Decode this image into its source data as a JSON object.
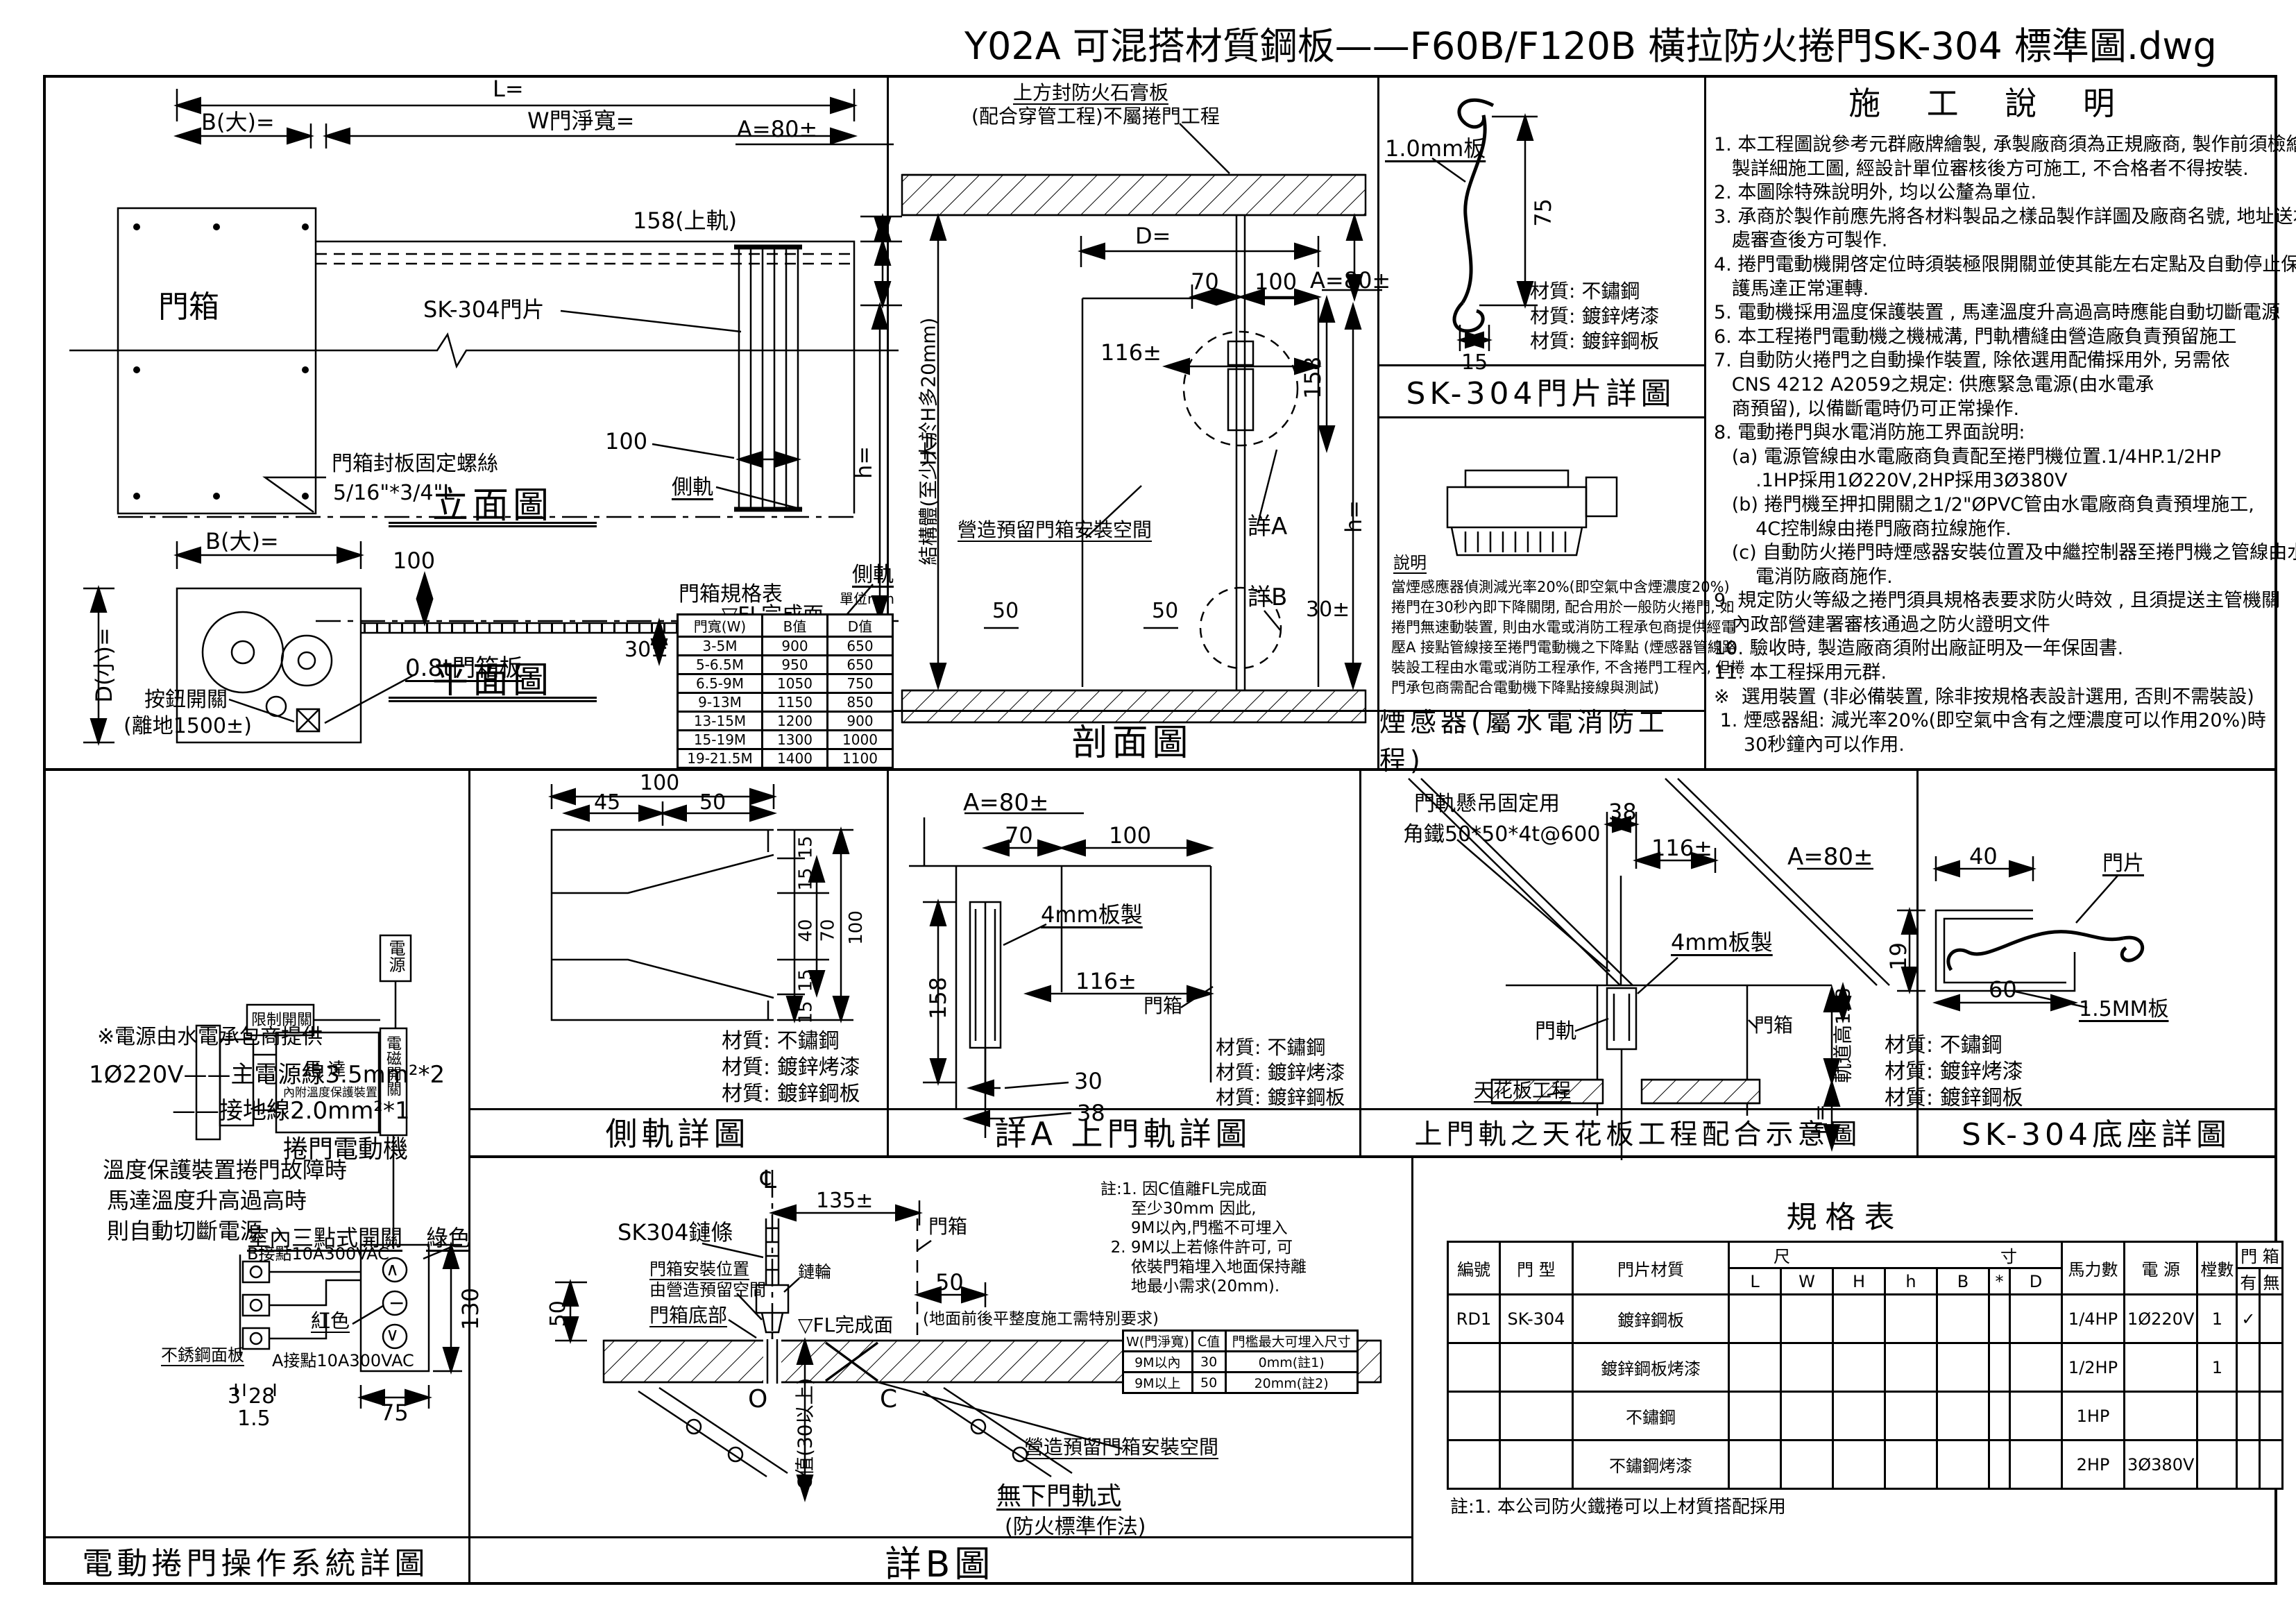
{
  "title": "Y02A 可混搭材質鋼板——F60B/F120B 橫拉防火捲門SK-304 標準圖.dwg",
  "materials": {
    "m1": "材質: 不鏽鋼",
    "m2": "材質: 鍍鋅烤漆",
    "m3": "材質: 鍍鋅鋼板"
  },
  "elevation": {
    "caption": "立面圖",
    "dim_l": "L=",
    "dim_b": "B(大)=",
    "dim_w": "W門淨寬=",
    "dim_a": "A=80±",
    "dim_rail": "158(上軌)",
    "dim_100": "100",
    "dim_h": "h=",
    "dim_30": "30±",
    "label_box": "門箱",
    "label_slat": "SK-304門片",
    "label_screw1": "門箱封板固定螺絲",
    "label_screw2": "5/16\"*3/4\"L",
    "label_siderail": "側軌",
    "label_fl": "▽FL完成面",
    "label_fl_note1": "(地面前後平整度",
    "label_fl_note2": "施工需特別要求)"
  },
  "plan": {
    "caption": "平面圖",
    "dim_b": "B(大)=",
    "dim_100": "100",
    "dim_d": "D(小)=",
    "label_switch1": "按鈕開關",
    "label_switch2": "(離地1500±)",
    "label_boxplate": "0.8t門箱板",
    "label_siderail": "側軌",
    "table": {
      "title": "門箱規格表",
      "unit": "單位mm",
      "h": [
        "門寬(W)",
        "B值",
        "D值"
      ],
      "rows": [
        [
          "3-5M",
          "900",
          "650"
        ],
        [
          "5-6.5M",
          "950",
          "650"
        ],
        [
          "6.5-9M",
          "1050",
          "750"
        ],
        [
          "9-13M",
          "1150",
          "850"
        ],
        [
          "13-15M",
          "1200",
          "900"
        ],
        [
          "15-19M",
          "1300",
          "1000"
        ],
        [
          "19-21.5M",
          "1400",
          "1100"
        ]
      ]
    }
  },
  "section": {
    "caption": "剖面圖",
    "note1": "上方封防火石膏板",
    "note2": "(配合穿管工程)不屬捲門工程",
    "dim_d": "D=",
    "dim_70": "70",
    "dim_100": "100",
    "dim_a": "A=80±",
    "dim_116": "116±",
    "dim_158": "158",
    "dim_50a": "50",
    "dim_50b": "50",
    "dim_30": "30±",
    "dim_h": "h=",
    "dim_H": "H=",
    "label_struct": "結構體(至少大於H多20mm)",
    "label_space": "營造預留門箱安裝空間",
    "label_detailA": "詳A",
    "label_detailB": "詳B"
  },
  "slat": {
    "caption": "SK-304門片詳圖",
    "dim_75": "75",
    "dim_15": "15",
    "label_plate": "1.0mm板"
  },
  "smoke": {
    "caption": "煙感器(屬水電消防工程)",
    "note_title": "說明",
    "lines": [
      "當煙感應器偵測減光率20%(即空氣中含煙濃度20%)",
      "捲門在30秒內即下降關閉, 配合用於一般防火捲門, 如",
      "捲門無速動裝置, 則由水電或消防工程承包商提供經電",
      "壓A 接點管線接至捲門電動機之下降點 (煙感器管線路",
      "裝設工程由水電或消防工程承作, 不含捲門工程內, 但捲",
      "門承包商需配合電動機下降點接線與測試)"
    ]
  },
  "notes": {
    "title": "施 工 說 明",
    "lines": [
      "1. 本工程圖說參考元群廠牌繪製, 承製廠商須為正規廠商, 製作前須檢繪",
      "   製詳細施工圖, 經設計單位審核後方可施工, 不合格者不得按裝.",
      "2. 本圖除特殊說明外, 均以公釐為單位.",
      "3. 承商於製作前應先將各材料製品之樣品製作詳圖及廠商名號, 地址送本",
      "   處審查後方可製作.",
      "4. 捲門電動機開啓定位時須裝極限開關並使其能左右定點及自動停止保",
      "   護馬達正常運轉.",
      "5. 電動機採用溫度保護裝置 , 馬達溫度升高過高時應能自動切斷電源",
      "6. 本工程捲門電動機之機械溝, 門軌槽縫由營造廠負責預留施工",
      "7. 自動防火捲門之自動操作裝置, 除依選用配備採用外, 另需依",
      "   CNS 4212 A2059之規定: 供應緊急電源(由水電承",
      "   商預留), 以備斷電時仍可正常操作.",
      "8. 電動捲門與水電消防施工界面說明:",
      "   (a) 電源管線由水電廠商負責配至捲門機位置.1/4HP.1/2HP",
      "       .1HP採用1Ø220V,2HP採用3Ø380V",
      "   (b) 捲門機至押扣開關之1/2\"ØPVC管由水電廠商負責預埋施工,",
      "       4C控制線由捲門廠商拉線施作.",
      "   (c) 自動防火捲門時煙感器安裝位置及中繼控制器至捲門機之管線由水",
      "       電消防廠商施作.",
      "9. 規定防火等級之捲門須具規格表要求防火時效 , 且須提送主管機關",
      "   內政部營建署審核通過之防火證明文件",
      "10. 驗收時, 製造廠商須附出廠証明及一年保固書.",
      "11. 本工程採用元群.",
      "※  選用裝置 (非必備裝置, 除非按規格表設計選用, 否則不需裝設)",
      " 1. 煙感器組: 減光率20%(即空氣中含有之煙濃度可以作用20%)時",
      "     30秒鐘內可以作用."
    ]
  },
  "motor": {
    "caption": "電動捲門操作系統詳圖",
    "power1": "※電源由水電承包商提供",
    "power2": "1Ø220V——主電源線3.5mm²*2",
    "power3": "——接地線2.0mm²*1",
    "label_power": "電源",
    "label_limit": "限制開關",
    "label_motor": "馬 達",
    "label_motor2": "內附溫度保護裝置",
    "label_mag": "電磁開關",
    "label_name": "捲門電動機",
    "temp1": "溫度保護裝置捲門故障時",
    "temp2": "馬達溫度升高過高時",
    "temp3": "則自動切斷電源",
    "label_switch": "室內三點式開關",
    "label_green": "綠色",
    "label_red": "紅色",
    "label_panel": "不銹鋼面板",
    "label_b": "B接點10A300VAC",
    "label_a": "A接點10A300VAC",
    "dim_130": "130",
    "dim_75": "75",
    "dim_3": "3",
    "dim_28": "28",
    "dim_15": "1.5",
    "sym_up": "∧",
    "sym_stop": "−",
    "sym_down": "∨"
  },
  "siderail": {
    "caption": "側軌詳圖",
    "dim_100t": "100",
    "dim_45": "45",
    "dim_50": "50",
    "d15a": "15",
    "d15b": "15",
    "d40": "40",
    "d70": "70",
    "d100": "100",
    "d15c": "15",
    "d15d": "15"
  },
  "detailA": {
    "caption": "詳A   上門軌詳圖",
    "dim_a": "A=80±",
    "dim_70": "70",
    "dim_100": "100",
    "dim_158": "158",
    "dim_116": "116±",
    "dim_30": "30",
    "dim_38": "38",
    "label_4mm": "4mm板製",
    "label_box": "門箱"
  },
  "ceiling": {
    "caption": "上門軌之天花板工程配合示意圖",
    "hang1": "門軌懸吊固定用",
    "hang2": "角鐵50*50*4t@600",
    "dim_38": "38",
    "dim_116": "116±",
    "dim_a": "A=80±",
    "label_4mm": "4mm板製",
    "label_rail": "門軌",
    "label_box": "門箱",
    "dim_track": "軌道高158",
    "label_ceiling": "天花板工程",
    "dim_h": "h="
  },
  "base": {
    "caption": "SK-304底座詳圖",
    "dim_40": "40",
    "dim_19": "19",
    "dim_60": "60",
    "label_15": "1.5MM板",
    "label_slat": "門片"
  },
  "detailB": {
    "caption": "詳B圖",
    "cl": "℄",
    "dim_135": "135±",
    "label_chain": "SK304鏈條",
    "label_box": "門箱",
    "label_pos1": "門箱安裝位置",
    "label_pos2": "由營造預留空間",
    "label_bottom": "門箱底部",
    "label_sprocket": "鏈輪",
    "dim_50l": "50",
    "dim_50r": "50",
    "label_fl": "▽FL完成面",
    "label_flnote": "(地面前後平整度施工需特別要求)",
    "label_o": "O",
    "label_c": "C",
    "dim_c": "C值(30以上)",
    "label_space": "營造預留門箱安裝空間",
    "label_method1": "無下門軌式",
    "label_method2": "(防火標準作法)",
    "notes": [
      "註:1. 因C值離FL完成面",
      "      至少30mm 因此,",
      "      9M以內,門檻不可埋入",
      "  2. 9M以上若條件許可, 可",
      "      依裝門箱埋入地面保持離",
      "      地最小需求(20mm)."
    ],
    "table": {
      "h": [
        "W(門淨寬)",
        "C值",
        "門檻最大可埋入尺寸"
      ],
      "rows": [
        [
          "9M以內",
          "30",
          "0mm(註1)"
        ],
        [
          "9M以上",
          "50",
          "20mm(註2)"
        ]
      ]
    }
  },
  "spec": {
    "title": "規格表",
    "h_no": "編號",
    "h_type": "門 型",
    "h_mat": "門片材質",
    "h_dim1": "尺",
    "h_dim2": "寸",
    "subcols": [
      "L",
      "W",
      "H",
      "h",
      "B",
      "*",
      "D"
    ],
    "h_hp": "馬力數",
    "h_power": "電 源",
    "h_qty": "樘數",
    "h_box": "門 箱",
    "h_yes": "有",
    "h_no2": "無",
    "rows": [
      {
        "no": "RD1",
        "type": "SK-304",
        "mat": "鍍鋅鋼板",
        "hp": "1/4HP",
        "power": "1Ø220V",
        "qty": "1",
        "yes": "✓"
      },
      {
        "no": "",
        "type": "",
        "mat": "鍍鋅鋼板烤漆",
        "hp": "1/2HP",
        "power": "",
        "qty": "1",
        "yes": ""
      },
      {
        "no": "",
        "type": "",
        "mat": "不鏽鋼",
        "hp": "1HP",
        "power": "",
        "qty": "",
        "yes": ""
      },
      {
        "no": "",
        "type": "",
        "mat": "不鏽鋼烤漆",
        "hp": "2HP",
        "power": "3Ø380V",
        "qty": "",
        "yes": ""
      }
    ],
    "note": "註:1. 本公司防火鐵捲可以上材質搭配採用"
  }
}
